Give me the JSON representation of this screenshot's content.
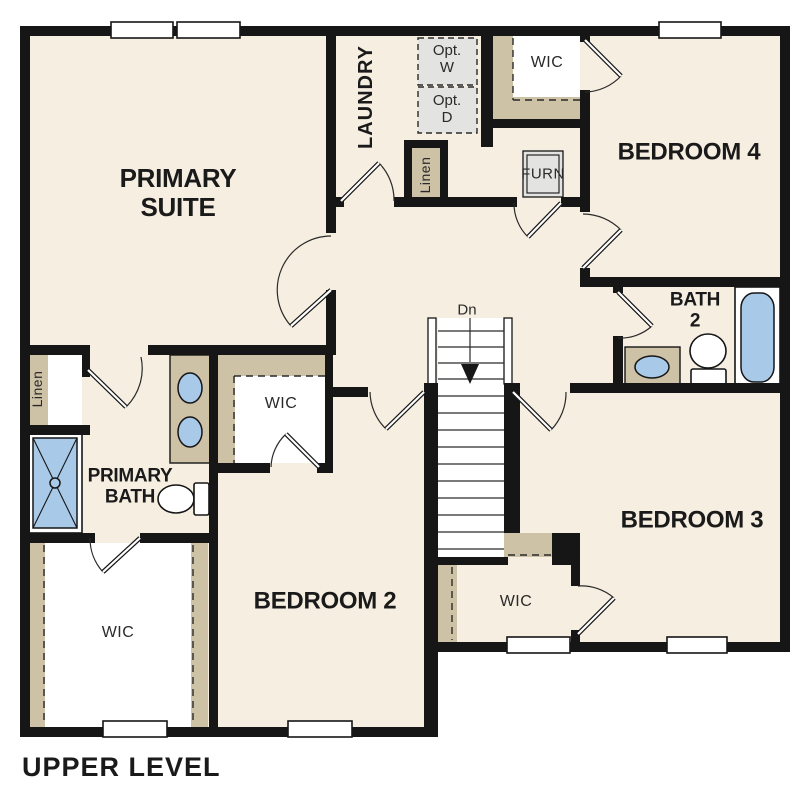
{
  "title": "UPPER LEVEL",
  "rooms": {
    "primary_suite": "PRIMARY SUITE",
    "laundry": "LAUNDRY",
    "bedroom4": "BEDROOM 4",
    "bedroom3": "BEDROOM 3",
    "bedroom2": "BEDROOM 2",
    "bath2": "BATH\n2",
    "primary_bath": "PRIMARY BATH",
    "wic_top": "WIC",
    "wic_middle": "WIC",
    "wic_bottom_left": "WIC",
    "wic_bottom_right": "WIC",
    "linen_hall": "Linen",
    "linen_bath": "Linen",
    "furnace": "FURN",
    "opt_washer": "Opt.\nW",
    "opt_dryer": "Opt.\nD",
    "stairs_down": "Dn"
  },
  "colors": {
    "floor": "#f6eee1",
    "closet_shelf": "#cdc1a6",
    "wall": "#161616",
    "fixture_blue": "#a9c9e9",
    "appliance_gray": "#e3e3e1",
    "background": "#ffffff",
    "text": "#1a1a1a"
  }
}
